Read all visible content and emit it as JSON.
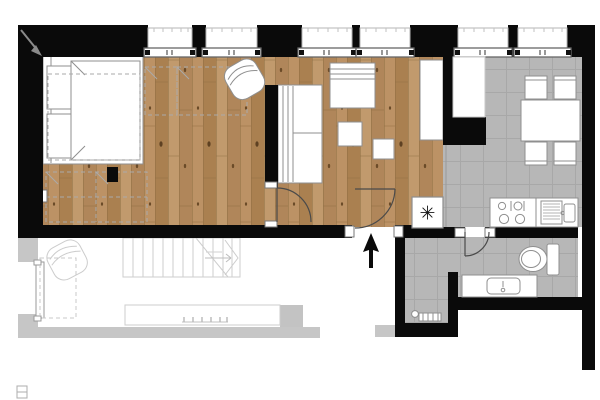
{
  "plan": {
    "kind": "apartment-floor-plan",
    "colors": {
      "paper": "#ffffff",
      "wall": "#0a0a0a",
      "wood": "#b58b5b",
      "tile": "#b7b7b7",
      "tile_grid": "#a8a8a8",
      "outline": "#8f8f8f",
      "dashed": "#aaaaaa",
      "faint": "#cccccc"
    },
    "symbols": {
      "boiler_star": "✳"
    },
    "icon_inventory": [
      "window",
      "double-bed",
      "pillow",
      "wardrobe-dashed",
      "armchair",
      "sofa",
      "dresser",
      "side-table",
      "tv-cabinet",
      "fridge-column",
      "dining-table",
      "chair",
      "stove-burners",
      "kitchen-sink",
      "boiler-star",
      "toilet",
      "washbasin-counter",
      "radiator-bench",
      "door-swing",
      "entrance-arrow",
      "stairs",
      "terrace-railing",
      "corner-arrow"
    ]
  }
}
